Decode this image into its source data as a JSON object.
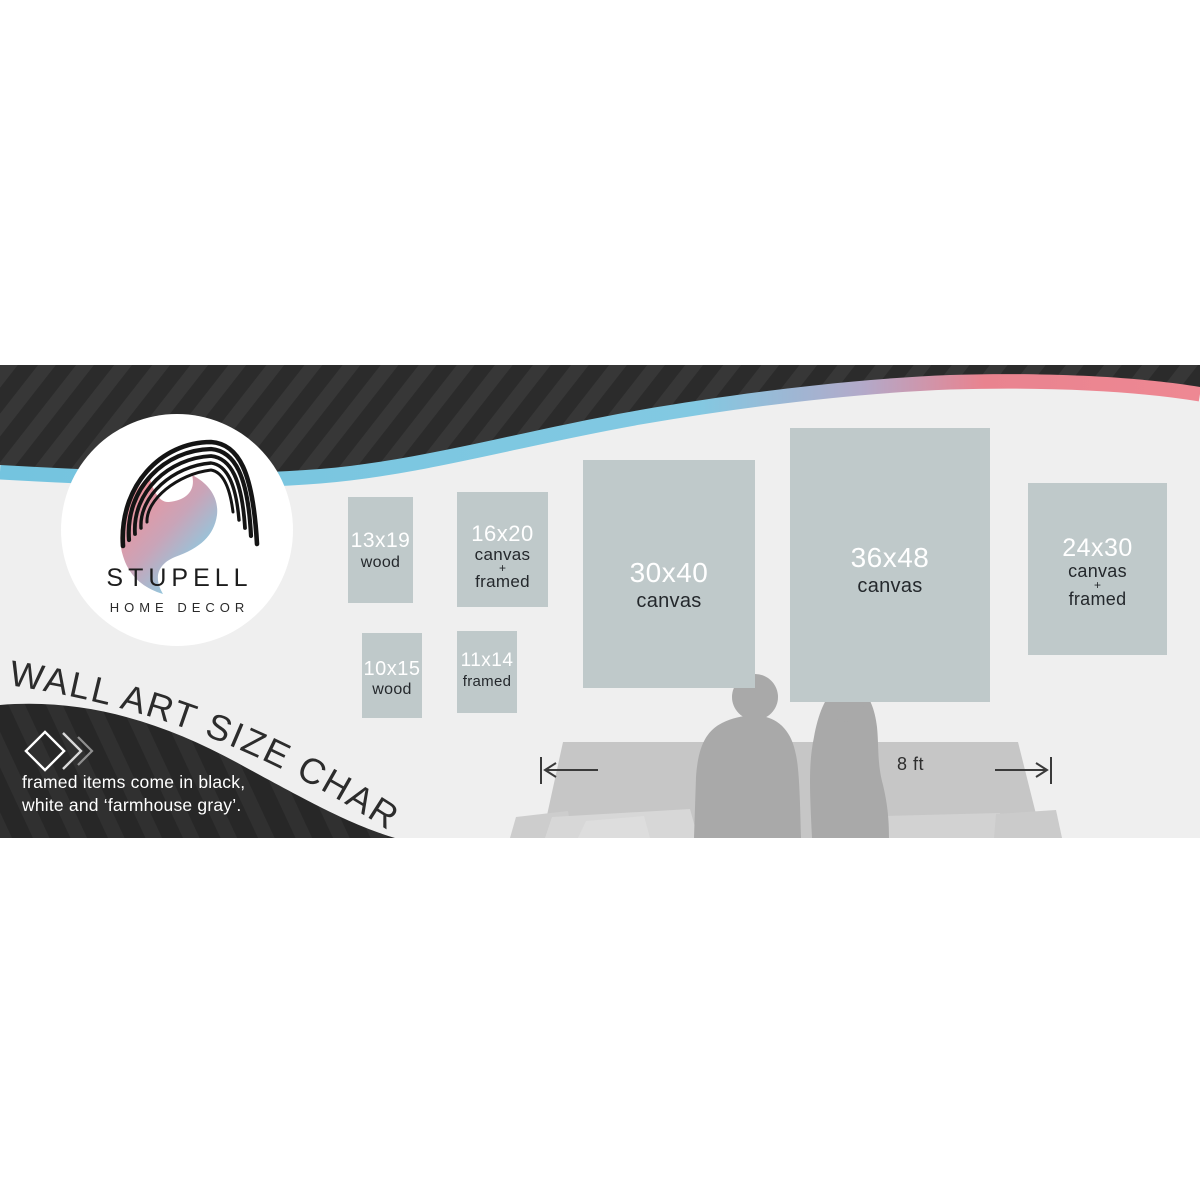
{
  "brand": {
    "name": "STUPELL",
    "tagline": "HOME DECOR"
  },
  "title": "WALL ART SIZE CHART",
  "note": {
    "line1": "framed items come in black,",
    "line2": "white and ‘farmhouse gray’."
  },
  "measurement": {
    "label": "8 ft"
  },
  "sizes": [
    {
      "size": "13x19",
      "lines": [
        "wood"
      ]
    },
    {
      "size": "16x20",
      "lines": [
        "canvas",
        "+",
        "framed"
      ]
    },
    {
      "size": "10x15",
      "lines": [
        "wood"
      ]
    },
    {
      "size": "11x14",
      "lines": [
        "framed"
      ]
    },
    {
      "size": "30x40",
      "lines": [
        "canvas"
      ]
    },
    {
      "size": "36x48",
      "lines": [
        "canvas"
      ]
    },
    {
      "size": "24x30",
      "lines": [
        "canvas",
        "+",
        "framed"
      ]
    }
  ],
  "icons": {
    "diamond": "diamond-outline",
    "chevrons": "double-chevron-right",
    "logo": "stupell-s-swoosh"
  },
  "colors": {
    "accent_blue": "#7cc6e0",
    "accent_pink": "#ec8490",
    "swoosh_dark": "#2b2b2b",
    "box_fill": "#bfc9ca",
    "background_gray": "#efefef",
    "silhouette_gray": "#a9a9a9",
    "couch_gray": "#c6c6c6"
  }
}
